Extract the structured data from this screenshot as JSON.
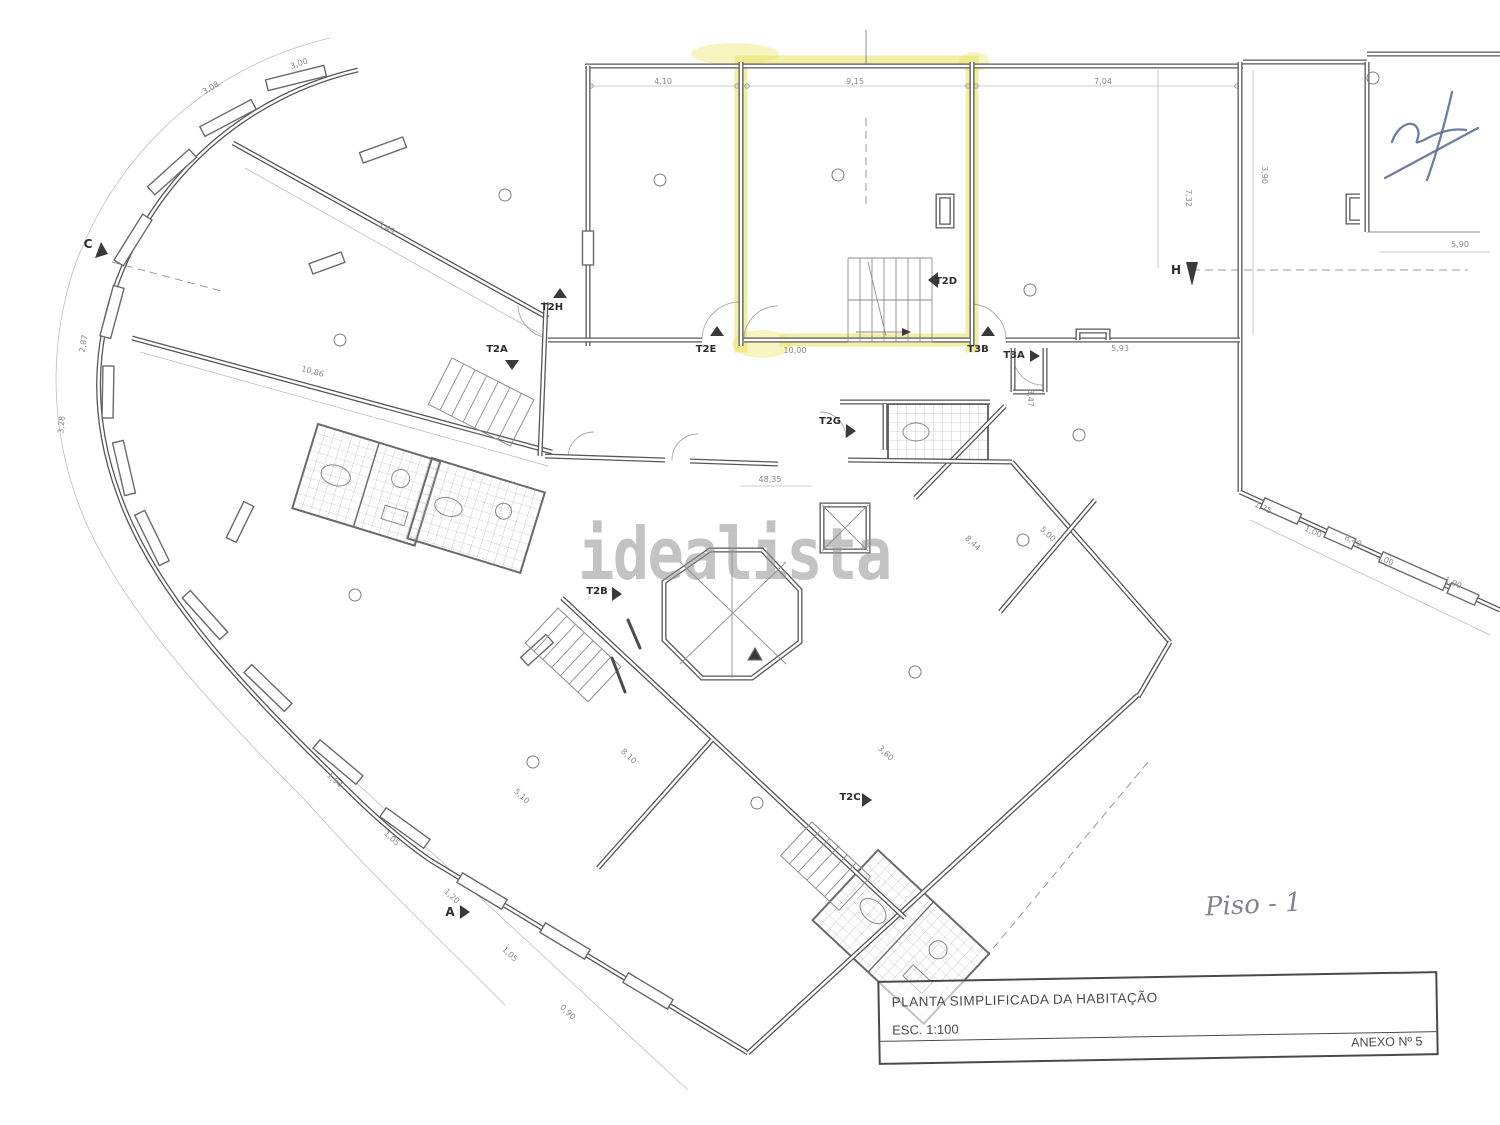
{
  "watermark": {
    "text": "idealista"
  },
  "handwriting": {
    "text": "Piso - 1"
  },
  "title_block": {
    "title": "PLANTA SIMPLIFICADA DA HABITAÇÃO",
    "scale": "ESC. 1:100",
    "annex": "ANEXO Nº 5"
  },
  "highlight": {
    "color": "#e9e269",
    "unit": "T2D"
  },
  "labels": [
    {
      "t": "T2E",
      "x": 706,
      "y": 352,
      "r": 0,
      "cls": "unit"
    },
    {
      "t": "T3B",
      "x": 978,
      "y": 352,
      "r": 0,
      "cls": "unit"
    },
    {
      "t": "T3A",
      "x": 1014,
      "y": 358,
      "r": 0,
      "cls": "unit"
    },
    {
      "t": "T2D",
      "x": 946,
      "y": 284,
      "r": 0,
      "cls": "unit"
    },
    {
      "t": "T2G",
      "x": 830,
      "y": 424,
      "r": 0,
      "cls": "unit"
    },
    {
      "t": "T2H",
      "x": 552,
      "y": 310,
      "r": 0,
      "cls": "unit"
    },
    {
      "t": "T2A",
      "x": 497,
      "y": 352,
      "r": 0,
      "cls": "unit"
    },
    {
      "t": "T2B",
      "x": 597,
      "y": 594,
      "r": 0,
      "cls": "unit"
    },
    {
      "t": "T2C",
      "x": 850,
      "y": 800,
      "r": 0,
      "cls": "unit"
    },
    {
      "t": "C",
      "x": 88,
      "y": 248,
      "r": 0,
      "cls": "sec"
    },
    {
      "t": "A",
      "x": 450,
      "y": 916,
      "r": 0,
      "cls": "sec"
    },
    {
      "t": "H",
      "x": 1176,
      "y": 274,
      "r": 0,
      "cls": "sec"
    },
    {
      "t": "4,10",
      "x": 663,
      "y": 84,
      "r": 0,
      "cls": "dim"
    },
    {
      "t": "9,15",
      "x": 855,
      "y": 84,
      "r": 0,
      "cls": "dim"
    },
    {
      "t": "7,04",
      "x": 1103,
      "y": 84,
      "r": 0,
      "cls": "dim"
    },
    {
      "t": "3,90",
      "x": 1262,
      "y": 175,
      "r": 90,
      "cls": "dim"
    },
    {
      "t": "7,32",
      "x": 1186,
      "y": 198,
      "r": 90,
      "cls": "dim"
    },
    {
      "t": "5,90",
      "x": 1460,
      "y": 247,
      "r": 0,
      "cls": "dim"
    },
    {
      "t": "5,93",
      "x": 1120,
      "y": 351,
      "r": 0,
      "cls": "dim"
    },
    {
      "t": "10,00",
      "x": 795,
      "y": 353,
      "r": 0,
      "cls": "dim"
    },
    {
      "t": "3,47",
      "x": 1028,
      "y": 398,
      "r": 90,
      "cls": "dim"
    },
    {
      "t": "48,35",
      "x": 770,
      "y": 482,
      "r": 0,
      "cls": "dim"
    },
    {
      "t": "5,49",
      "x": 385,
      "y": 230,
      "r": 29,
      "cls": "dim"
    },
    {
      "t": "10,86",
      "x": 312,
      "y": 374,
      "r": 15,
      "cls": "dim"
    },
    {
      "t": "8,44",
      "x": 971,
      "y": 545,
      "r": 43,
      "cls": "dim"
    },
    {
      "t": "5,00",
      "x": 1046,
      "y": 536,
      "r": 43,
      "cls": "dim"
    },
    {
      "t": "8,10",
      "x": 627,
      "y": 758,
      "r": 43,
      "cls": "dim"
    },
    {
      "t": "3,60",
      "x": 884,
      "y": 755,
      "r": 43,
      "cls": "dim"
    },
    {
      "t": "5,10",
      "x": 520,
      "y": 798,
      "r": 43,
      "cls": "dim"
    },
    {
      "t": "8,40",
      "x": 1352,
      "y": 543,
      "r": 25,
      "cls": "dim"
    },
    {
      "t": "1,75",
      "x": 1262,
      "y": 510,
      "r": 25,
      "cls": "dim"
    },
    {
      "t": "1,00",
      "x": 1312,
      "y": 534,
      "r": 25,
      "cls": "dim"
    },
    {
      "t": "3,00",
      "x": 1384,
      "y": 562,
      "r": 25,
      "cls": "dim"
    },
    {
      "t": "1,00",
      "x": 1452,
      "y": 585,
      "r": 25,
      "cls": "dim"
    },
    {
      "t": "3,08",
      "x": 212,
      "y": 90,
      "r": -30,
      "cls": "dim"
    },
    {
      "t": "3,00",
      "x": 300,
      "y": 66,
      "r": -20,
      "cls": "dim"
    },
    {
      "t": "2,87",
      "x": 86,
      "y": 344,
      "r": -80,
      "cls": "dim"
    },
    {
      "t": "3,28",
      "x": 64,
      "y": 425,
      "r": -85,
      "cls": "dim"
    },
    {
      "t": "1,94",
      "x": 333,
      "y": 782,
      "r": 43,
      "cls": "dim"
    },
    {
      "t": "1,05",
      "x": 390,
      "y": 840,
      "r": 43,
      "cls": "dim"
    },
    {
      "t": "1,20",
      "x": 450,
      "y": 898,
      "r": 43,
      "cls": "dim"
    },
    {
      "t": "1,05",
      "x": 508,
      "y": 956,
      "r": 43,
      "cls": "dim"
    },
    {
      "t": "0,90",
      "x": 566,
      "y": 1014,
      "r": 43,
      "cls": "dim"
    }
  ]
}
